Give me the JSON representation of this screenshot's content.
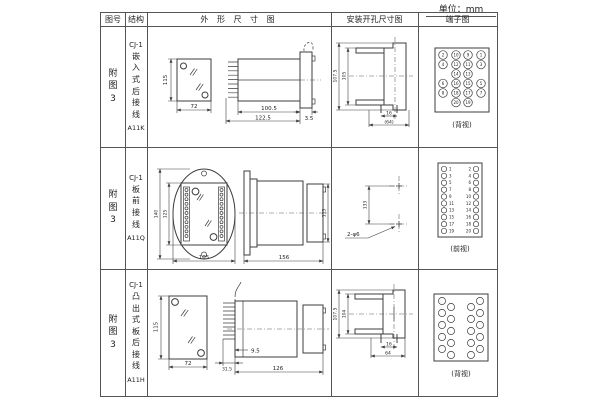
{
  "unit_label": "单位：mm",
  "headers": {
    "fig": "图号",
    "structure": "结构",
    "outline": "外 形 尺 寸 图",
    "install": "安装开孔尺寸图",
    "terminal": "端子图"
  },
  "rows": [
    {
      "fig": "附图3",
      "model": "CJ-1",
      "mount": "嵌入式后接线",
      "code": "A11K",
      "outline": {
        "h": "115",
        "w": "72",
        "d1": "100.5",
        "d2": "122.5",
        "d3": "3.5"
      },
      "install": {
        "v1": "107.5",
        "v2": "105",
        "h1": "16",
        "h2": "(64)"
      },
      "terminal": {
        "view": "(背视)",
        "numbers": [
          "2",
          "10",
          "9",
          "1",
          "4",
          "12",
          "11",
          "3",
          "14",
          "13",
          "6",
          "16",
          "15",
          "5",
          "8",
          "18",
          "17",
          "7",
          "20",
          "19"
        ]
      }
    },
    {
      "fig": "附图3",
      "model": "CJ-1",
      "mount": "板前接线",
      "code": "A11Q",
      "outline": {
        "h1": "140",
        "h2": "125",
        "w": "105",
        "d1": "156",
        "d2": "115"
      },
      "install": {
        "v1": "133",
        "holes": "2-φ6"
      },
      "terminal": {
        "view": "(前视)",
        "left": [
          "1",
          "3",
          "5",
          "7",
          "9",
          "11",
          "13",
          "15",
          "17",
          "19"
        ],
        "right": [
          "2",
          "4",
          "6",
          "8",
          "10",
          "12",
          "14",
          "16",
          "18",
          "20"
        ]
      }
    },
    {
      "fig": "附图3",
      "model": "CJ-1",
      "mount": "凸出式板后接线",
      "code": "A11H",
      "outline": {
        "h": "115",
        "w": "72",
        "d1": "31.5",
        "d2": "9.5",
        "d3": "126"
      },
      "install": {
        "v1": "107.5",
        "v2": "104",
        "h1": "16",
        "h2": "64"
      },
      "terminal": {
        "view": "(背视)"
      }
    }
  ]
}
